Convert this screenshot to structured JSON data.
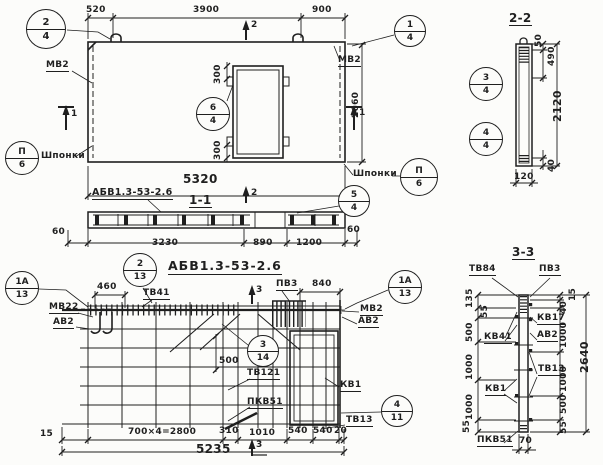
{
  "colors": {
    "ink": "#1f1f1f",
    "paper": "#fcfcfa"
  },
  "elevation": {
    "mark_label": "АБВ1.3-53-2.6",
    "dims": {
      "w1": "520",
      "w2": "3900",
      "w3": "900",
      "height": "2660",
      "total_width": "5320",
      "opening_top": "300",
      "opening_bottom": "300"
    },
    "labels": {
      "mv2_left": "МВ2",
      "mv2_right": "МВ2",
      "keys_left": "Шпонки",
      "keys_right": "Шпонки"
    },
    "callouts": {
      "c2_4": {
        "num": "2",
        "sheet": "4"
      },
      "c1_4": {
        "num": "1",
        "sheet": "4"
      },
      "c6_4": {
        "num": "6",
        "sheet": "4"
      },
      "keys_left": {
        "num": "П",
        "sheet": "6"
      },
      "keys_right": {
        "num": "П",
        "sheet": "6"
      }
    },
    "marks": {
      "s2_top": "2",
      "s2_bottom": "2",
      "s1_left": "1",
      "s1_right": "1"
    }
  },
  "section_1_1": {
    "title": "1-1",
    "dims": {
      "left_60": "60",
      "d3230": "3230",
      "d890": "890",
      "d1200": "1200",
      "right_60": "60"
    },
    "callouts": {
      "c5_4": {
        "num": "5",
        "sheet": "4"
      }
    }
  },
  "section_2_2": {
    "title": "2-2",
    "dims": {
      "d50": "50",
      "d490": "490",
      "d2120": "2120",
      "d40": "40",
      "d120": "120"
    },
    "callouts": {
      "c3_4": {
        "num": "3",
        "sheet": "4"
      },
      "c4_4": {
        "num": "4",
        "sheet": "4"
      }
    }
  },
  "plan": {
    "title": "АБВ1.3-53-2.6",
    "dims": {
      "d460": "460",
      "d840": "840",
      "d500": "500",
      "d15": "15",
      "spacing": "700×4=2800",
      "d310": "310",
      "d1010": "1010",
      "d540a": "540",
      "d540b": "540",
      "d20": "20",
      "total": "5235"
    },
    "labels": {
      "tv41": "ТВ41",
      "mv22": "МВ22",
      "av2_left": "АВ2",
      "pv3": "ПВ3",
      "mv2": "МВ2",
      "av2_right": "АВ2",
      "kv1": "КВ1",
      "tv121": "ТВ121",
      "pkv51": "ПКВ51",
      "tv13": "ТВ13"
    },
    "callouts": {
      "c2_13": {
        "num": "2",
        "sheet": "13"
      },
      "c1a_13_left": {
        "num": "1А",
        "sheet": "13"
      },
      "c1a_13_right": {
        "num": "1А",
        "sheet": "13"
      },
      "c3_14": {
        "num": "3",
        "sheet": "14"
      },
      "c4_11": {
        "num": "4",
        "sheet": "11"
      }
    },
    "marks": {
      "s3_top": "3",
      "s3_bottom": "3"
    }
  },
  "section_3_3": {
    "title": "3-3",
    "labels": {
      "tv84": "ТВ84",
      "pv3": "ПВ3",
      "kv17": "КВ17",
      "av2": "АВ2",
      "kv41": "КВ41",
      "tv13": "ТВ13",
      "kv1": "КВ1",
      "pkv51": "ПКВ51"
    },
    "dims_left": {
      "d135": "135",
      "d55a": "55",
      "d500": "500",
      "d1000a": "1000",
      "d1000b": "1000",
      "d55b": "55"
    },
    "dims_right": {
      "d15": "15",
      "d40": "40",
      "d1000a": "1000",
      "d1000b": "1000",
      "d500": "500",
      "d55": "55",
      "total": "2640"
    },
    "dim_bottom": "70"
  }
}
